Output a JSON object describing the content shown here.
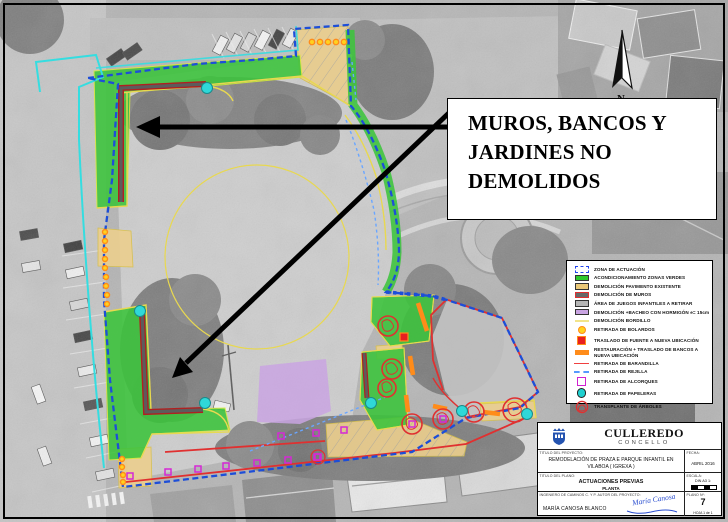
{
  "annotation": {
    "text": "MUROS, BANCOS Y\nJARDINES  NO\nDEMOLIDOS"
  },
  "north": {
    "label": "N"
  },
  "legend": {
    "items": [
      {
        "label": "ZONA DE ACTUACIÓN",
        "color": "#2244ee"
      },
      {
        "label": "ACONDICIONAMIENTO ZONAS VERDES",
        "color": "#2ec82e"
      },
      {
        "label": "DEMOLICIÓN PAVIMENTO EXISTENTE",
        "color": "#eac878"
      },
      {
        "label": "DEMOLICIÓN DE MUROS",
        "color": "#686868"
      },
      {
        "label": "ÁREA DE JUEGOS INFANTILES A RETIRAR",
        "color": "#b6b6b6"
      },
      {
        "label": "DEMOLICIÓN +BACHEO CON HORMIGÓN e= 15cm",
        "color": "#c9a4e2"
      },
      {
        "label": "DEMOLICIÓN BORDILLO",
        "color": "#f2e48a"
      },
      {
        "label": "RETIRADA DE BOLARDOS",
        "color": "#ff9016"
      },
      {
        "label": "TRASLADO DE FUENTE A NUEVA UBICACIÓN",
        "color": "#e82020"
      },
      {
        "label": "RESTAURACIÓN + TRASLADO DE BANCOS A NUEVA UBICACIÓN",
        "color": "#ff8c1a"
      },
      {
        "label": "RETIRADA DE BARANDILLA",
        "color": "#f04040"
      },
      {
        "label": "RETIRADA DE REJILLA",
        "color": "#5599ff"
      },
      {
        "label": "RETIRADA DE ALCORQUES",
        "color": "#d020d0"
      },
      {
        "label": "RETIRADA DE PAPELERAS",
        "color": "#20d0d0"
      },
      {
        "label": "TRANSPLANTE DE ÁRBOLES",
        "color": "#e03030"
      }
    ]
  },
  "titleblock": {
    "org_name": "CULLEREDO",
    "org_sub": "CONCELLO",
    "project_label": "TITULO DEL PROYECTO:",
    "project_value": "REMODELACIÓN DE PRAZA E PARQUE INFANTIL EN VILABOA  ( IGREXA )",
    "fecha_label": "FECHA:",
    "fecha_value": "ABRIL 2016",
    "plano_label": "TITULO DEL PLANO:",
    "plano_value_1": "ACTUACIONES  PREVIAS",
    "plano_value_2": "PLANTA",
    "escala_label": "ESCALA:",
    "escala_value": "DIN A3  1:",
    "autor_label": "INGENIERO DE CAMINOS C. Y P. AUTOR DEL PROYECTO:",
    "autor_value": "MARÍA CANOSA BLANCO",
    "firma": "María Canosa",
    "plano_num_label": "PLANO Nº:",
    "plano_num_value": "7",
    "hoja_value": "HOJA  1  de  1"
  }
}
